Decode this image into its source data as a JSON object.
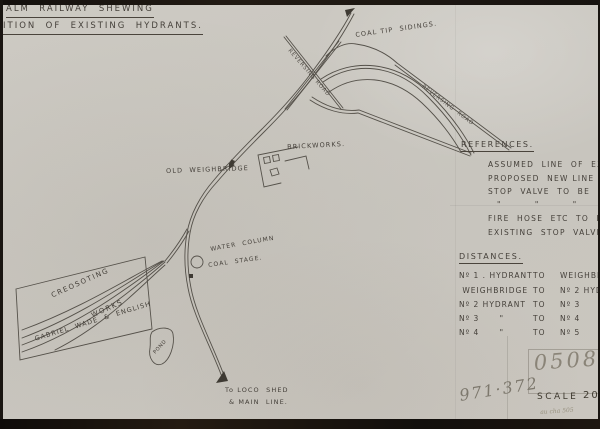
{
  "header": {
    "title_line1": "ALM  RAILWAY  SHEWING",
    "title_line2": "ITION  OF  EXISTING  HYDRANTS."
  },
  "map_labels": {
    "new_extension": "To NEW EXTENSION WITH",
    "coal_tip_sidings": "COAL TIP  SIDINGS.",
    "reversing_road_upper": "REVERSING ROAD",
    "reversing_road_lower": "REVERSING  ROAD",
    "old_weighbridge": "OLD  WEIGHBRIDGE",
    "brickworks": "BRICKWORKS.",
    "water_column": "WATER  COLUMN",
    "coal_stage": "COAL  STAGE.",
    "yard_name_line1": "CREOSOTING",
    "yard_name_line2": "WORKS",
    "yard_name_line3": "GABRIEL  WADE  &  ENGLISH",
    "pond": "POND",
    "loco_shed_line1": "To LOCO  SHED",
    "loco_shed_line2": "& MAIN  LINE."
  },
  "references": {
    "heading": "REFERENCES.",
    "lines": [
      "ASSUMED  LINE  OF  EXISTING  M",
      "PROPOSED  NEW LINE TO KEEP  PO",
      "STOP  VALVE  TO  BE  FITTED  HERE",
      "\"         \"         \"         \"",
      "FIRE  HOSE  ETC  TO  BE  KEPT  H",
      "EXISTING  STOP  VALVE  TO  BE"
    ]
  },
  "distances": {
    "heading": "DISTANCES.",
    "rows": [
      {
        "from": "Nº 1 . HYDRANT",
        "to": "TO",
        "dest": "WEIGHBRIDGE."
      },
      {
        "from": " WEIGHBRIDGE",
        "to": "TO",
        "dest": "Nº 2 HYDRANT"
      },
      {
        "from": "Nº 2 HYDRANT",
        "to": "TO",
        "dest": "Nº 3      \""
      },
      {
        "from": "Nº 3      \"",
        "to": "TO",
        "dest": "Nº 4      \""
      },
      {
        "from": "Nº 4      \"",
        "to": "TO",
        "dest": "Nº 5      \""
      }
    ]
  },
  "footer": {
    "ref_number": "0508",
    "archive_number": "971·372",
    "scale_label": "SCALE",
    "scale_value": "200",
    "pencil_note": "au cha 505"
  },
  "colors": {
    "paper": "#c9c6bf",
    "ink": "#45403a",
    "track": "#55514a",
    "border": "#191511",
    "pencil": "#8a8478"
  }
}
